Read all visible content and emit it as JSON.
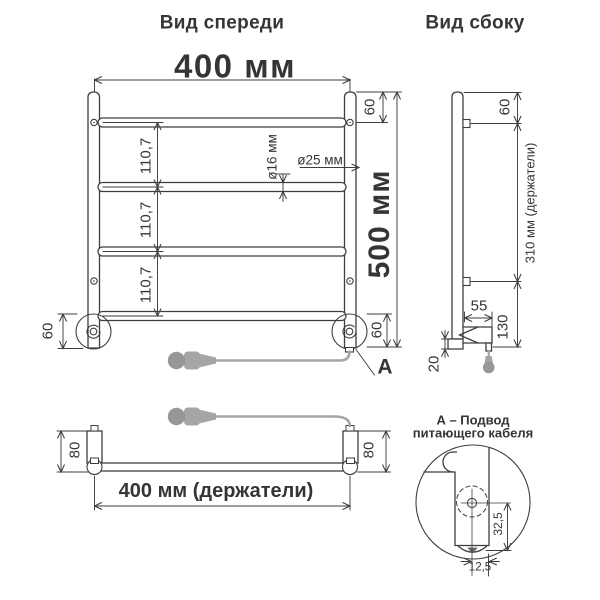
{
  "front": {
    "title": "Вид спереди",
    "width": "400 мм",
    "height": "500 мм",
    "spacings": [
      "110,7",
      "110,7",
      "110,7"
    ],
    "tube_diameter": "ø16 мм",
    "collector_diameter": "ø25 мм",
    "top_offset": "60",
    "bottom_offset_left": "60",
    "bottom_offset_right": "60",
    "cable_callout": "А"
  },
  "side": {
    "title": "Вид сбоку",
    "top_offset": "60",
    "holders_span": "310 мм (держатели)",
    "housing_depth": "55",
    "bottom_section": "130",
    "foot_height": "20"
  },
  "top": {
    "holder_left": "80",
    "holder_right": "80",
    "holders_width": "400 мм (держатели)"
  },
  "detail": {
    "title_line1": "А – Подвод",
    "title_line2": "питающего кабеля",
    "vertical_offset": "32,5",
    "horizontal_offset": "12,5"
  },
  "colors": {
    "line": "#3e3e41",
    "text": "#353537",
    "cable": "#a5a5a5"
  }
}
